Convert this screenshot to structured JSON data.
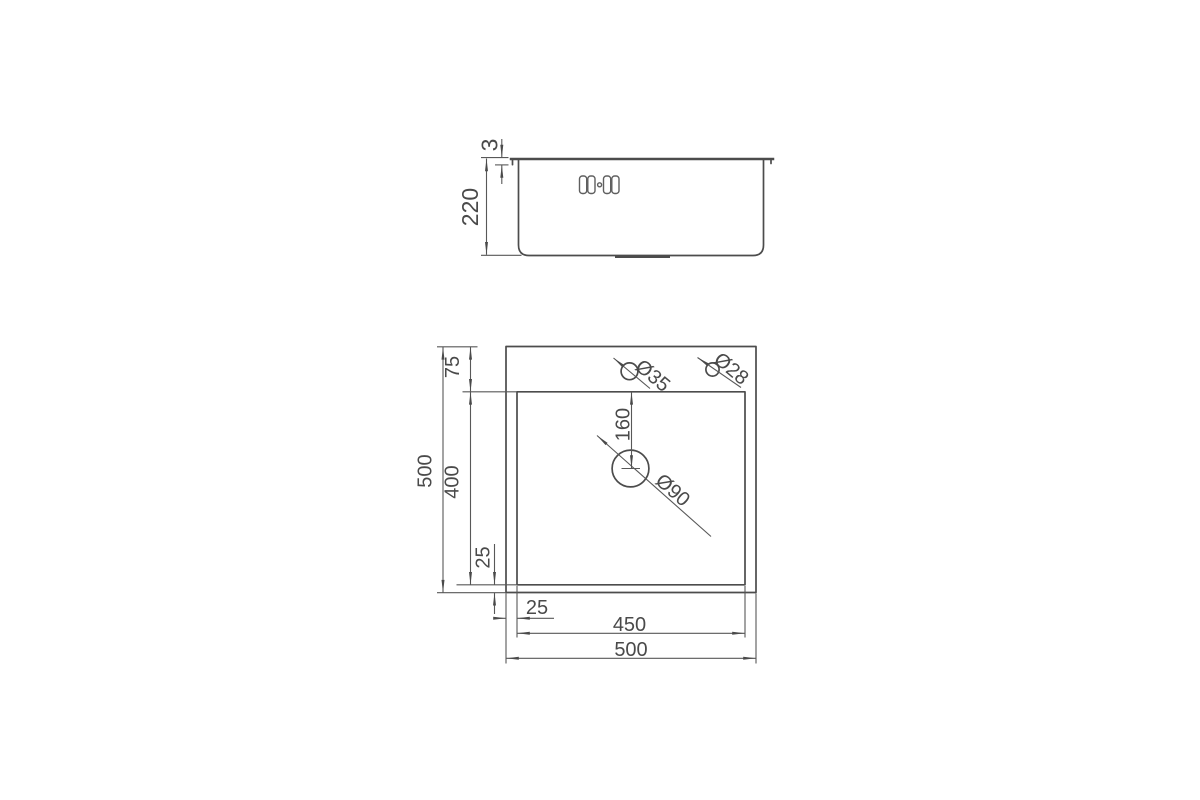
{
  "views": {
    "side": {
      "dims": {
        "flange_thickness": "3",
        "overall_height": "220"
      }
    },
    "plan": {
      "dims": {
        "overall_height": "500",
        "overall_width": "500",
        "top_offset": "75",
        "bowl_height": "400",
        "bowl_bottom_offset": "25",
        "bowl_left_offset": "25",
        "bowl_width": "450",
        "drain_center_offset": "160"
      },
      "holes": {
        "faucet": "Ø35",
        "accessory": "Ø28",
        "drain": "Ø90"
      }
    }
  },
  "colors": {
    "line": "#4a4a4a",
    "background": "#ffffff"
  }
}
